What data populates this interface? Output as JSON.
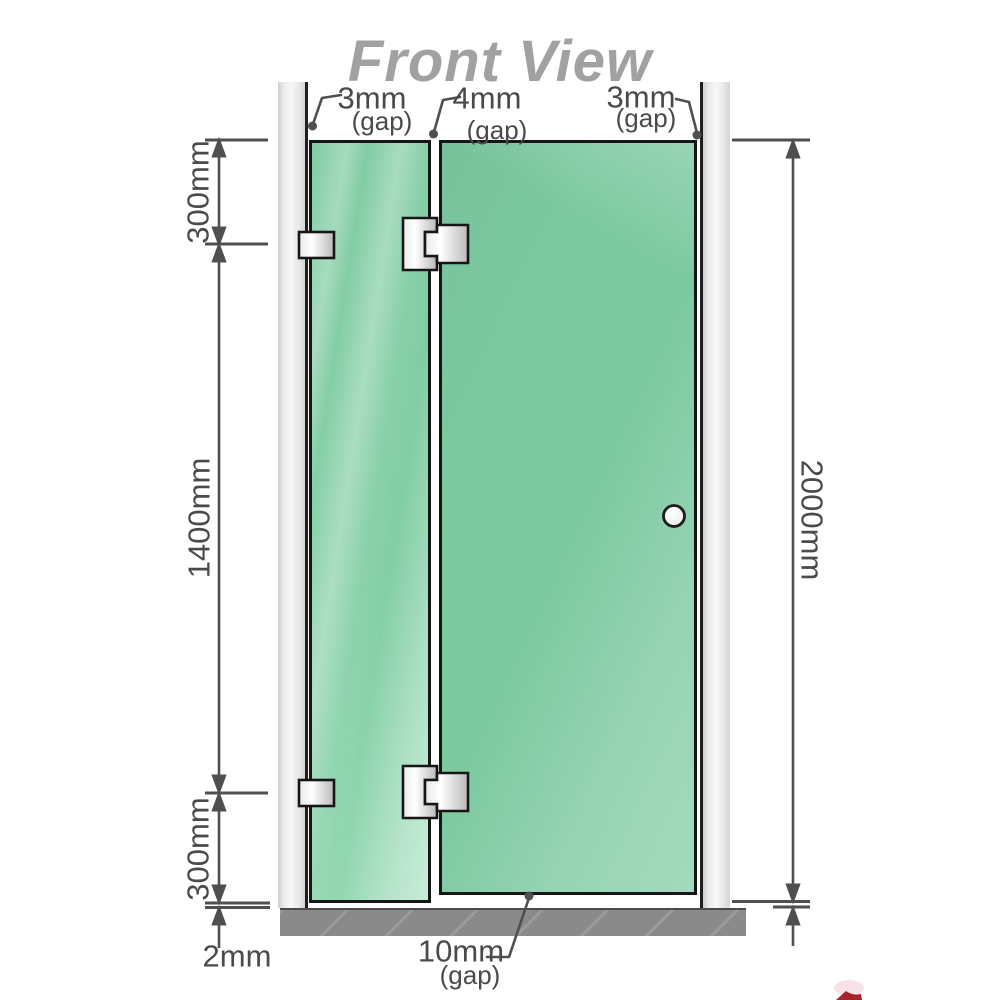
{
  "title": "Front View",
  "diagram": {
    "top_gaps": [
      {
        "value": "3mm",
        "unit": "(gap)"
      },
      {
        "value": "4mm",
        "unit": "(gap)"
      },
      {
        "value": "3mm",
        "unit": "(gap)"
      }
    ],
    "left_dims": {
      "top": "300mm",
      "middle": "1400mm",
      "bottom": "300mm",
      "floor_gap": "2mm"
    },
    "right_dims": {
      "total_height": "2000mm"
    },
    "bottom_gap": {
      "value": "10mm",
      "unit": "(gap)"
    },
    "colors": {
      "glass": "#7cc9a0",
      "glass_highlight": "#b9e8d0",
      "wall_channel": "#ececec",
      "floor": "#8a8a8a",
      "dimension_text": "#4a4a4c",
      "title_text": "#a1a1a4",
      "hardware_outline": "#161616",
      "accent_red": "#a6212a"
    }
  }
}
